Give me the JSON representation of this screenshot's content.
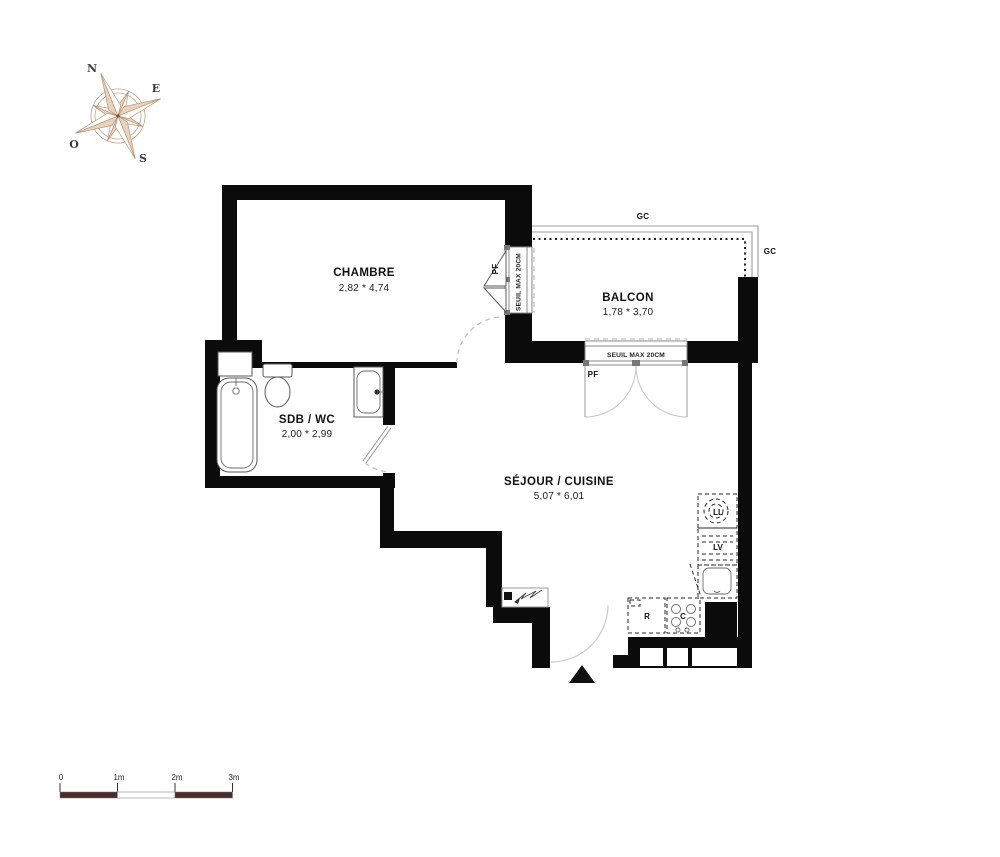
{
  "compass": {
    "north": "N",
    "east": "E",
    "south": "S",
    "west": "O"
  },
  "rooms": {
    "chambre": {
      "name": "CHAMBRE",
      "dims": "2,82 * 4,74"
    },
    "balcon": {
      "name": "BALCON",
      "dims": "1,78 * 3,70"
    },
    "sdb": {
      "name": "SDB / WC",
      "dims": "2,00 * 2,99"
    },
    "sejour": {
      "name": "SÉJOUR / CUISINE",
      "dims": "5,07 * 6,01"
    }
  },
  "openings": {
    "gc_top": "GC",
    "gc_right": "GC",
    "pf_window_chambre": "PF",
    "pf_window_balcon": "PF",
    "seuil_window_chambre": "SEUIL MAX 20CM",
    "seuil_window_balcon": "SEUIL MAX 20CM"
  },
  "appliances": {
    "washing_machine": "LL",
    "dishwasher": "LV",
    "fridge": "R",
    "cooktop": "C"
  },
  "scale_bar": {
    "ticks": [
      "0",
      "1m",
      "2m",
      "3m"
    ]
  },
  "colors": {
    "wall": "#0b0b0b",
    "compass_fill": "#e7d3bb",
    "compass_stroke": "#b79678",
    "scale_dark": "#4a2c2c",
    "fixture_stroke": "#5a5a5a"
  }
}
